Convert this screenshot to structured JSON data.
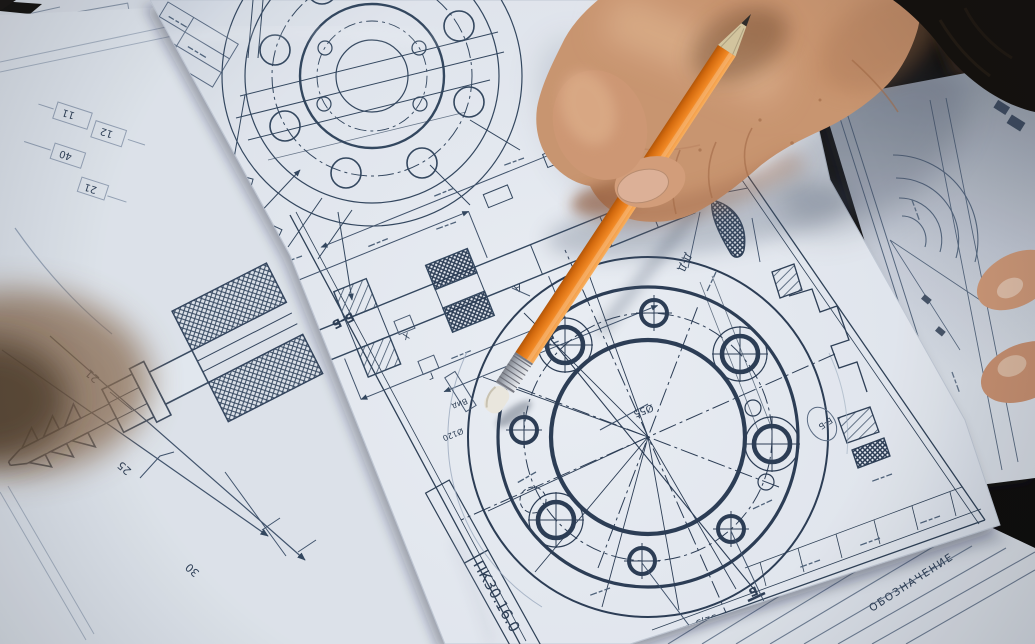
{
  "center_sheet": {
    "stamp_code": "ПК30.16.0",
    "section_label": "Б-Б",
    "balloon_label": "Б-Б",
    "detail_label": "Д-Д",
    "cut_letter_top": "Б",
    "cut_letter_bottom": "Б",
    "datum_letter": "А",
    "box_letter_1": "Х",
    "box_letter_2": "Г",
    "dim_bore": "Ø55",
    "dim_flange": "Ø120",
    "dim_offset": "52,5",
    "view_note": "Вид"
  },
  "left_sheet": {
    "top_dims": [
      "11",
      "12",
      "40",
      "21"
    ],
    "fitting_dims": [
      "21",
      "25",
      "30"
    ]
  },
  "notes_sheet": {
    "heading": "ОБОЗНАЧЕНИЕ"
  },
  "palette": {
    "pencil_orange": "#F5821F",
    "paper_white": "#ECEFF5",
    "ink_blue": "#34465E",
    "skin_tan": "#D49A76",
    "sleeve_black": "#140E09",
    "background_dark": "#0E0A07"
  }
}
